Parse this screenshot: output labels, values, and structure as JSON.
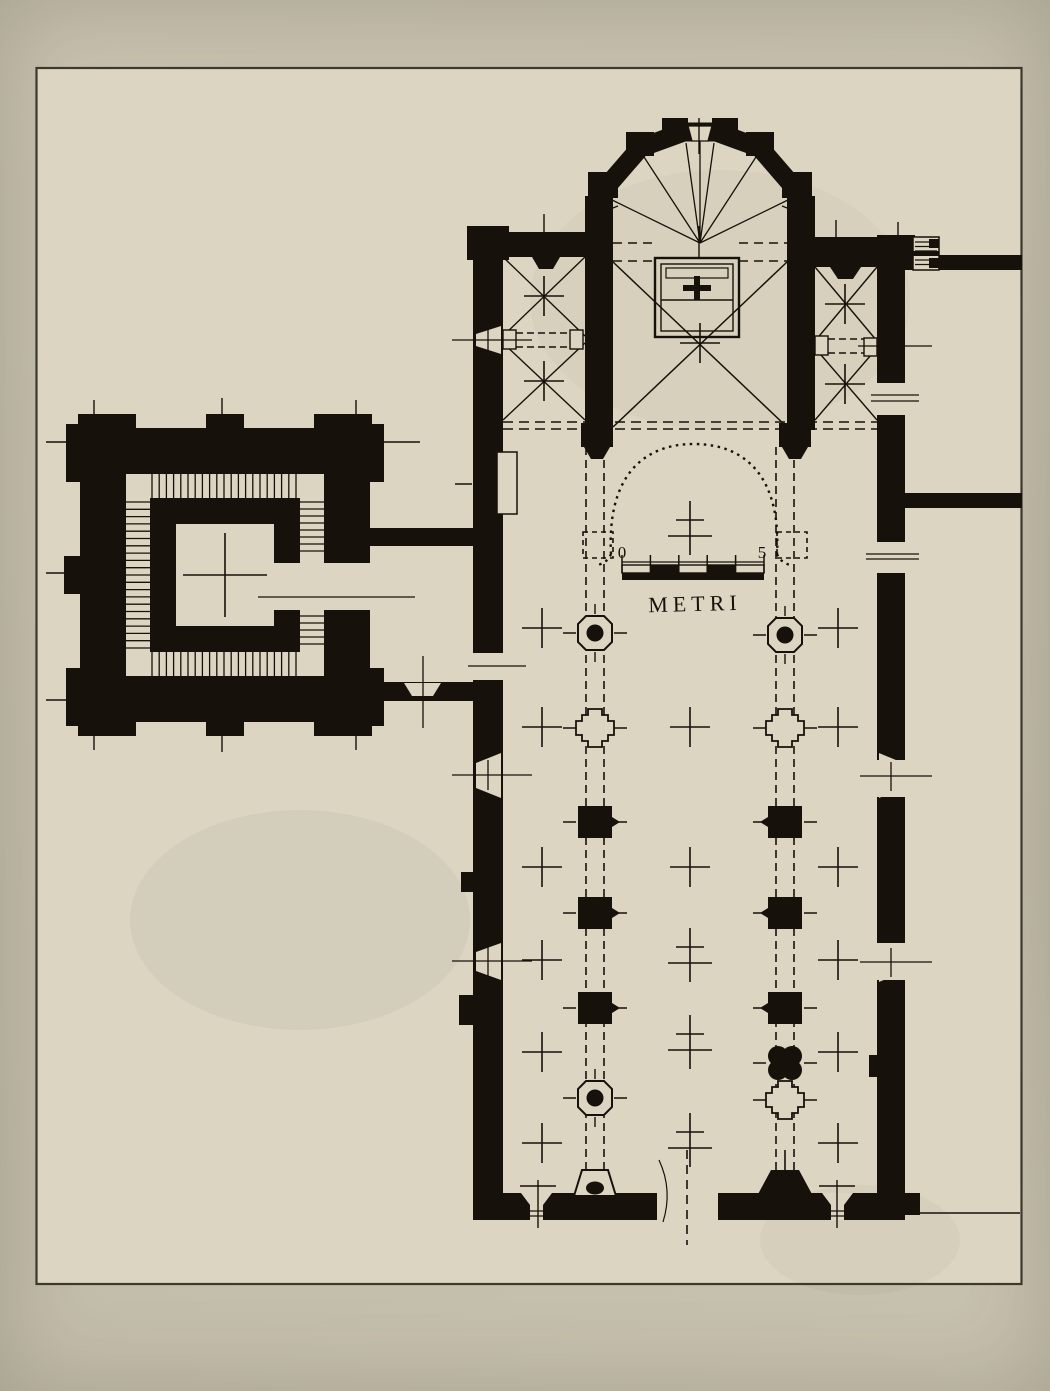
{
  "artifact": {
    "kind": "black-and-white photograph of a measured architectural drawing",
    "subject": "floor plan of a church with aisled nave, side chapels, polygonal apse and a detached square bell tower with internal staircase",
    "orientation": "nave vertical, apse at top, entrance facade at bottom"
  },
  "colors": {
    "paper_outer": "#c7c1af",
    "paper_inner": "#dbd5c2",
    "ink": "#16120b",
    "frame_line": "#3c382c"
  },
  "scale_bar": {
    "start_label": "0",
    "end_label": "5",
    "unit_label": "METRI",
    "divisions": 5
  },
  "piers": {
    "left_row": {
      "cx": 595,
      "items": [
        {
          "type": "octagon-dot",
          "y": 633
        },
        {
          "type": "cruciform",
          "y": 728
        },
        {
          "type": "square",
          "y": 822
        },
        {
          "type": "square",
          "y": 913
        },
        {
          "type": "square",
          "y": 1008
        },
        {
          "type": "octagon-dot",
          "y": 1098
        },
        {
          "type": "base-outline",
          "y": 1183
        }
      ]
    },
    "right_row": {
      "cx": 785,
      "items": [
        {
          "type": "octagon-dot",
          "y": 635
        },
        {
          "type": "cruciform",
          "y": 728
        },
        {
          "type": "square",
          "y": 822
        },
        {
          "type": "square",
          "y": 913
        },
        {
          "type": "square",
          "y": 1008
        },
        {
          "type": "quatrefoil",
          "y": 1063
        },
        {
          "type": "cruciform",
          "y": 1100
        },
        {
          "type": "base-solid",
          "y": 1183
        }
      ]
    }
  },
  "cross_marks": {
    "single": [
      {
        "x": 542,
        "y": 628
      },
      {
        "x": 542,
        "y": 727
      },
      {
        "x": 542,
        "y": 867
      },
      {
        "x": 542,
        "y": 960
      },
      {
        "x": 542,
        "y": 1052
      },
      {
        "x": 542,
        "y": 1143
      },
      {
        "x": 838,
        "y": 628
      },
      {
        "x": 838,
        "y": 727
      },
      {
        "x": 838,
        "y": 867
      },
      {
        "x": 838,
        "y": 960
      },
      {
        "x": 838,
        "y": 1052
      },
      {
        "x": 838,
        "y": 1143
      },
      {
        "x": 690,
        "y": 727
      },
      {
        "x": 690,
        "y": 867
      },
      {
        "x": 544,
        "y": 296
      },
      {
        "x": 544,
        "y": 381
      },
      {
        "x": 845,
        "y": 304
      },
      {
        "x": 845,
        "y": 384
      },
      {
        "x": 700,
        "y": 343
      },
      {
        "x": 225,
        "y": 575,
        "arm": 42
      }
    ],
    "double": [
      {
        "x": 690,
        "y": 528
      },
      {
        "x": 690,
        "y": 955
      },
      {
        "x": 690,
        "y": 1042
      },
      {
        "x": 690,
        "y": 1140
      }
    ]
  }
}
